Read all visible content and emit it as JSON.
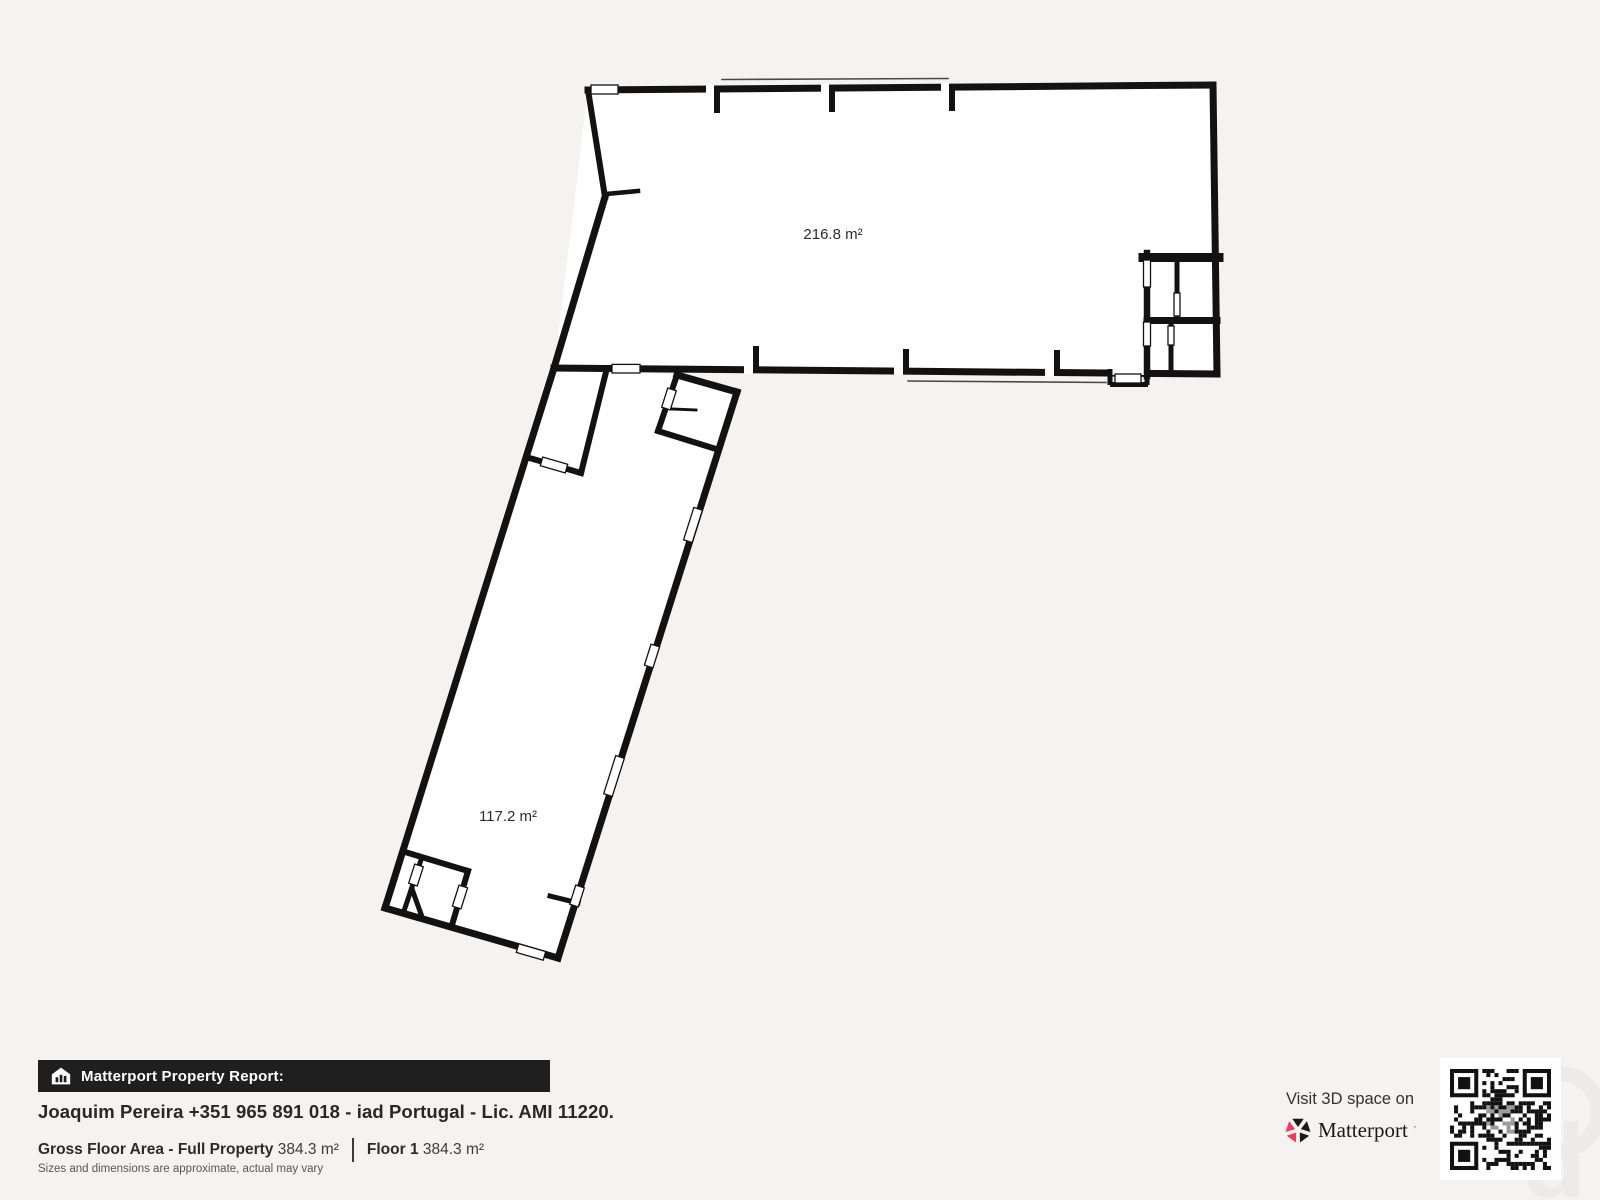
{
  "page": {
    "background": "#f4f3f1"
  },
  "floor_plan": {
    "floor_color": "#ffffff",
    "wall_color": "#121212",
    "rooms": [
      {
        "name": "upper-hall",
        "area": "216.8 m²"
      },
      {
        "name": "lower-hall",
        "area": "117.2 m²"
      }
    ]
  },
  "footer": {
    "report_bar": {
      "icon": "house-chart-icon",
      "label": "Matterport Property Report:",
      "bg": "#1f1f1f"
    },
    "agent_line": "Joaquim Pereira +351 965 891 018 - iad Portugal - Lic. AMI 11220.",
    "metrics": {
      "gross_label": "Gross Floor Area - Full Property",
      "gross_value": "384.3 m²",
      "floor_label": "Floor 1",
      "floor_value": "384.3 m²"
    },
    "disclaimer": "Sizes and dimensions are approximate, actual may vary"
  },
  "cta": {
    "visit_text": "Visit 3D space on",
    "brand_name": "Matterport",
    "brand_mark": "’",
    "brand_red": "#ef3a5d",
    "qr": "qr-code"
  }
}
